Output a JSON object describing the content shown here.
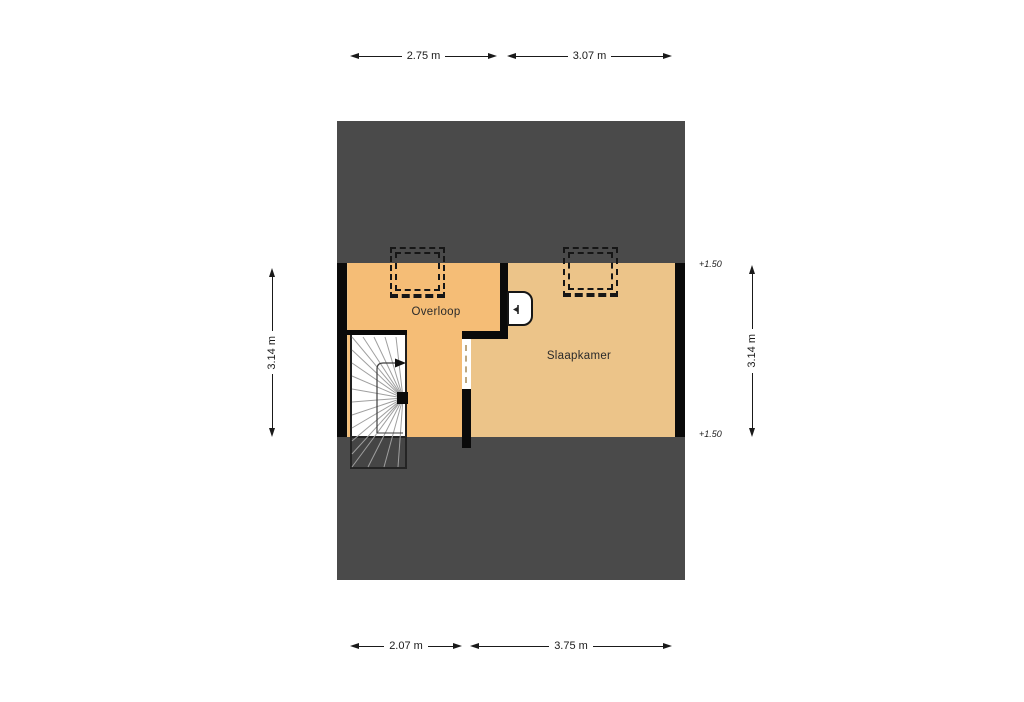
{
  "floorplan": {
    "type": "floor-plan",
    "colors": {
      "roof": "#4a4a4a",
      "wall": "#0a0a0a",
      "room_overloop_fill": "#f5bd76",
      "room_slaapkamer_fill": "#ecc489",
      "stairs_fill": "#ffffff",
      "background": "#ffffff"
    },
    "rooms": [
      {
        "label": "Overloop"
      },
      {
        "label": "Slaapkamer"
      }
    ],
    "level_markers": [
      {
        "label": "+1.50"
      },
      {
        "label": "+1.50"
      }
    ],
    "dimensions": {
      "top": [
        {
          "label": "2.75 m"
        },
        {
          "label": "3.07 m"
        }
      ],
      "bottom": [
        {
          "label": "2.07 m"
        },
        {
          "label": "3.75 m"
        }
      ],
      "left": [
        {
          "label": "3.14 m"
        }
      ],
      "right": [
        {
          "label": "3.14 m"
        }
      ]
    },
    "features": [
      {
        "name": "staircase"
      },
      {
        "name": "roof-window"
      },
      {
        "name": "dormer-outline-left"
      },
      {
        "name": "dormer-outline-right"
      },
      {
        "name": "door-opening"
      }
    ]
  }
}
